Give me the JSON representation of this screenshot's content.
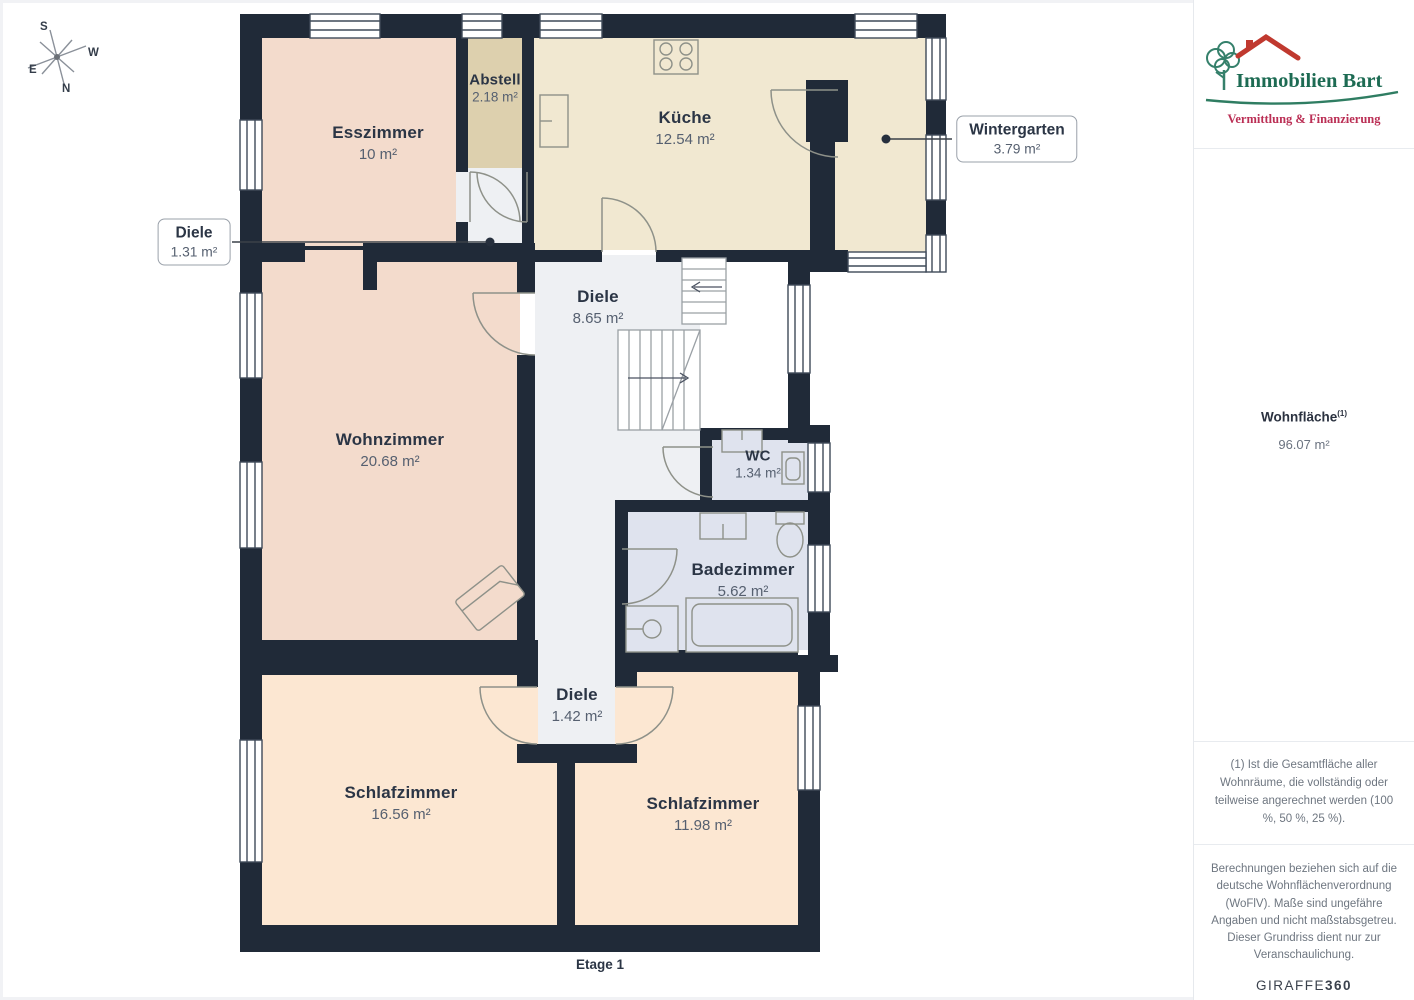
{
  "plan": {
    "floor_label": "Etage 1",
    "rooms": [
      {
        "name": "Esszimmer",
        "area": "10 m²"
      },
      {
        "name": "Abstell",
        "area": "2.18 m²"
      },
      {
        "name": "Küche",
        "area": "12.54 m²"
      },
      {
        "name": "Diele",
        "area": "8.65 m²"
      },
      {
        "name": "Wohnzimmer",
        "area": "20.68 m²"
      },
      {
        "name": "WC",
        "area": "1.34 m²"
      },
      {
        "name": "Badezimmer",
        "area": "5.62 m²"
      },
      {
        "name": "Diele",
        "area": "1.42 m²"
      },
      {
        "name": "Schlafzimmer",
        "area": "16.56 m²"
      },
      {
        "name": "Schlafzimmer",
        "area": "11.98 m²"
      }
    ],
    "callouts": [
      {
        "name": "Diele",
        "area": "1.31 m²"
      },
      {
        "name": "Wintergarten",
        "area": "3.79 m²"
      }
    ],
    "compass": {
      "n": "N",
      "s": "S",
      "e": "E",
      "w": "W"
    }
  },
  "sidebar": {
    "logo": {
      "title": "Immobilien Bart",
      "subtitle": "Vermittlung & Finanzierung"
    },
    "area_summary": {
      "label": "Wohnfläche",
      "superscript": "(1)",
      "value": "96.07 m²"
    },
    "footnote": "(1) Ist die Gesamtfläche aller Wohnräume, die vollständig oder teilweise angerechnet werden (100 %, 50 %, 25 %).",
    "disclaimer": "Berechnungen beziehen sich auf die deutsche Wohnflächenverordnung (WoFlV). Maße sind ungefähre Angaben und nicht maßstabsgetreu. Dieser Grundriss dient nur zur Veranschaulichung.",
    "brand": {
      "giraffe": "GIRAFFE",
      "three_sixty": "360"
    }
  },
  "colors": {
    "wall": "#202a38",
    "room_pink": "#f3dbcc",
    "room_tan": "#ddd0ae",
    "room_cream": "#f1e8d1",
    "room_gray": "#eef0f3",
    "room_blue": "#dfe3ee",
    "room_peach": "#fce7d2",
    "logo_green": "#1d6b53",
    "logo_red": "#c0392f",
    "logo_subtitle_red": "#bb2f55"
  }
}
